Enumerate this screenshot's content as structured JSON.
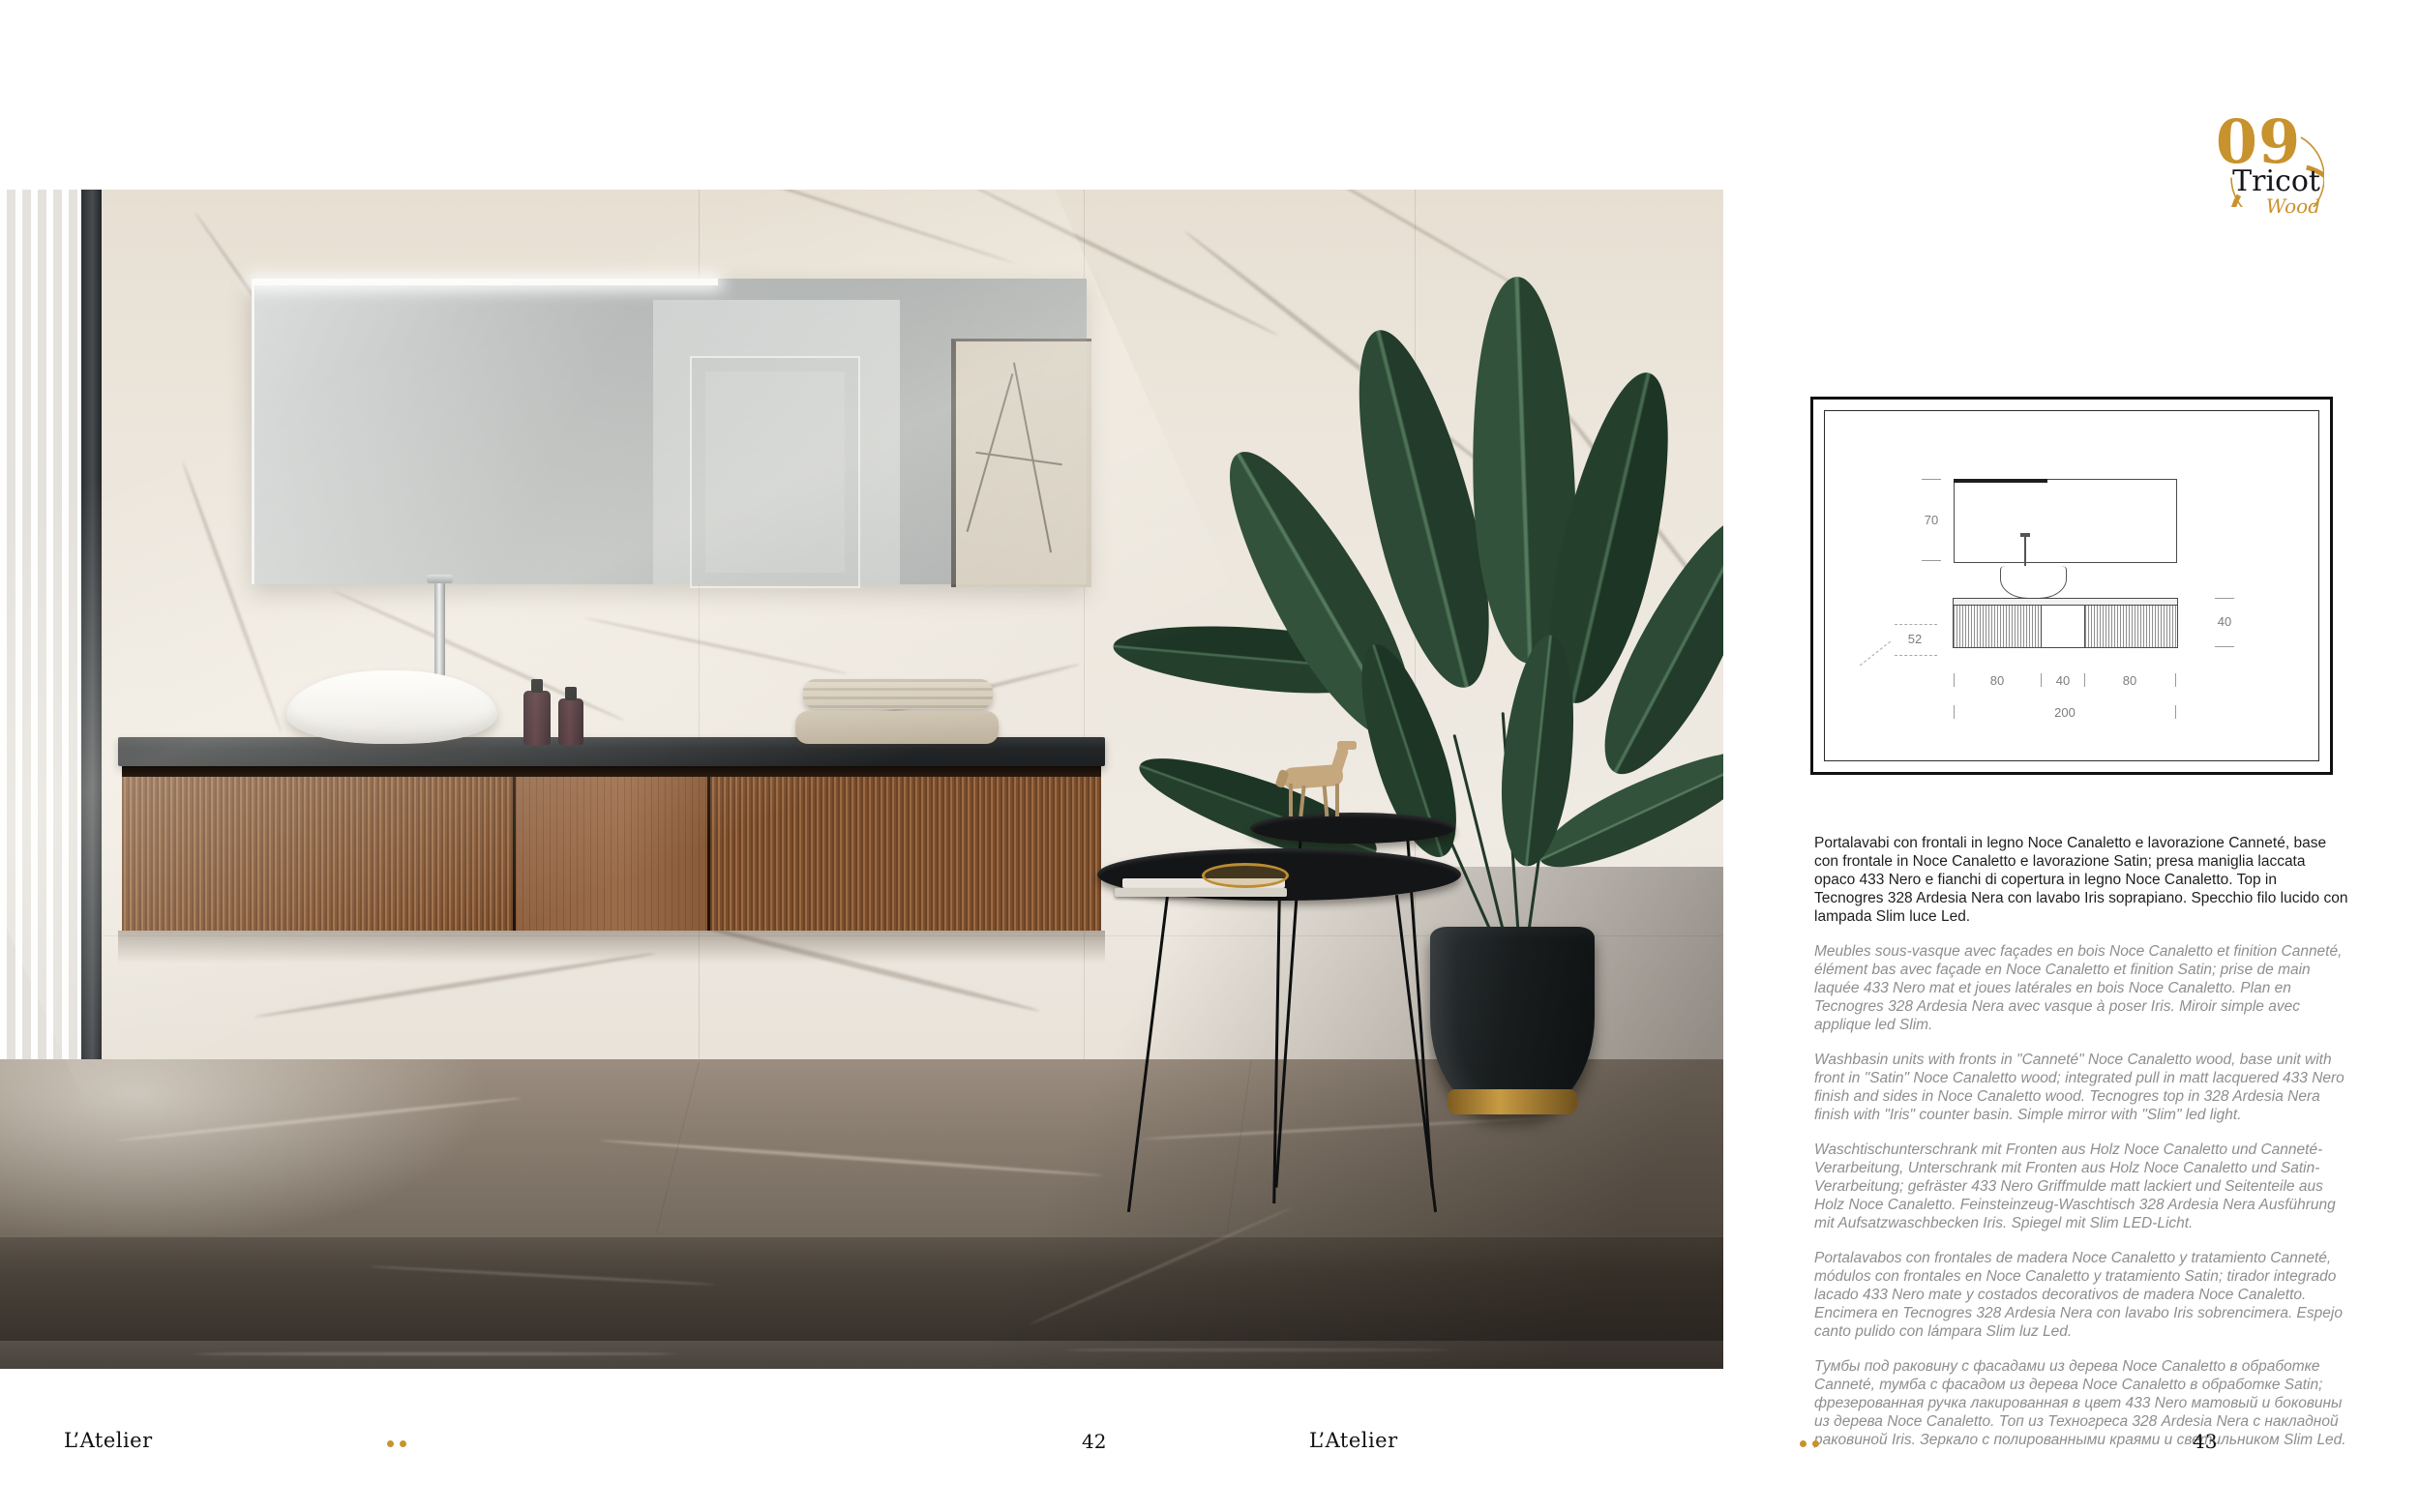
{
  "page": {
    "brand": "L’Atelier",
    "left_page_number": "42",
    "right_page_number": "43"
  },
  "collection_badge": {
    "number": "09",
    "name": "Tricot",
    "material": "Wood"
  },
  "technical_drawing": {
    "mirror_height": "70",
    "depth": "52",
    "unit_height": "40",
    "widths": [
      "80",
      "40",
      "80"
    ],
    "total_width": "200"
  },
  "description": {
    "it": "Portalavabi con frontali in legno Noce Canaletto e lavorazione Canneté, base con frontale in Noce Canaletto e lavorazione Satin; presa maniglia laccata opaco 433 Nero e fianchi di copertura in legno Noce Canaletto. Top in Tecnogres 328 Ardesia Nera con lavabo Iris soprapiano. Specchio filo lucido con lampada Slim luce Led.",
    "fr": "Meubles sous-vasque avec façades en bois Noce Canaletto et finition Canneté, élément bas avec façade en Noce Canaletto et finition Satin; prise de main laquée 433 Nero mat et joues latérales en bois Noce Canaletto. Plan en Tecnogres 328 Ardesia Nera avec vasque à poser Iris. Miroir simple avec applique led Slim.",
    "en": "Washbasin units with fronts in \"Canneté\" Noce Canaletto wood, base unit with front in \"Satin\" Noce Canaletto wood; integrated pull in matt lacquered 433 Nero finish and sides in Noce Canaletto wood. Tecnogres top in 328 Ardesia Nera finish with \"Iris\" counter basin. Simple mirror with \"Slim\" led light.",
    "de": "Waschtischunterschrank mit Fronten aus Holz Noce Canaletto und Canneté-Verarbeitung, Unterschrank mit Fronten aus Holz Noce Canaletto und Satin-Verarbeitung; gefräster 433 Nero Griffmulde matt lackiert und Seitenteile aus Holz Noce Canaletto. Feinsteinzeug-Waschtisch 328 Ardesia Nera Ausführung mit Aufsatzwaschbecken Iris. Spiegel mit Slim LED-Licht.",
    "es": "Portalavabos con frontales de madera Noce Canaletto y tratamiento Canneté, módulos con frontales en Noce Canaletto y tratamiento Satin; tirador integrado lacado 433 Nero mate y costados decorativos de madera Noce Canaletto. Encimera en Tecnogres 328 Ardesia Nera con lavabo Iris sobrencimera. Espejo canto pulido con lámpara Slim luz Led.",
    "ru": "Тумбы под раковину с фасадами из дерева Noce Canaletto в обработке Canneté, тумба с фасадом из дерева Noce Canaletto в обработке Satin; фрезерованная ручка лакированная в цвет 433 Nero матовый и боковины из дерева Noce Canaletto. Топ из Техногреса 328 Ardesia Nera с накладной раковиной Iris. Зеркало с полированными краями и светильником Slim Led."
  },
  "colors": {
    "accent_gold": "#c8922c",
    "text_dark": "#1e1e1e",
    "text_gray": "#8e8e8e"
  }
}
